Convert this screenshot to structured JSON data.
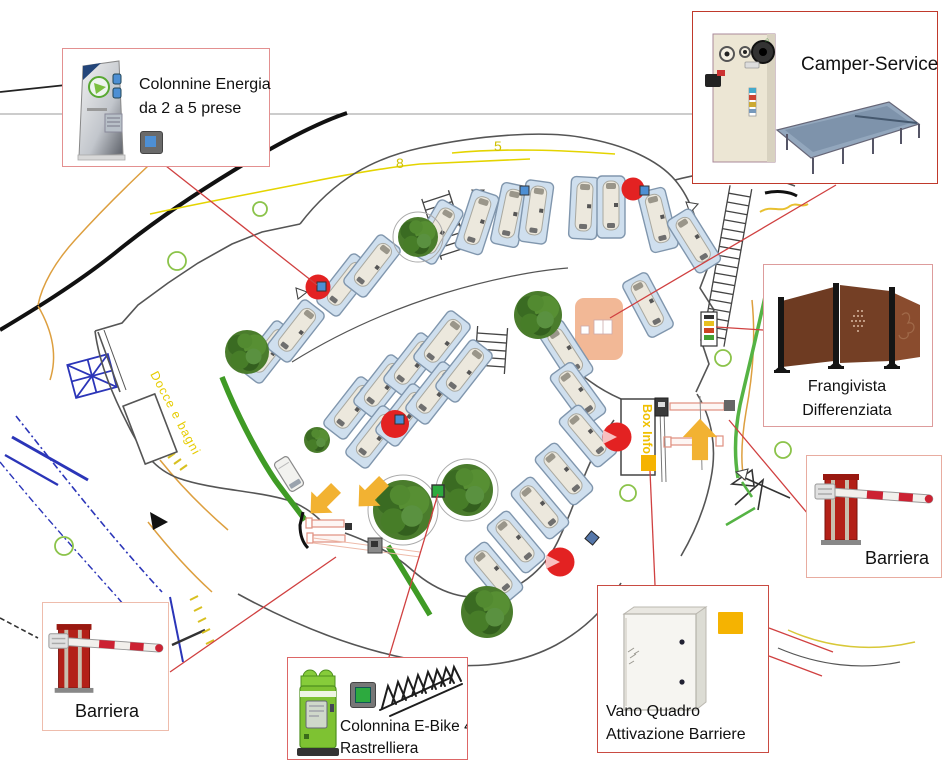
{
  "callouts": {
    "energia": {
      "line1": "Colonnine Energia",
      "line2": "da 2 a 5 prese"
    },
    "camper_service": {
      "label": "Camper-Service"
    },
    "frangivista": {
      "line1": "Frangivista",
      "line2": "Differenziata"
    },
    "barriera_right": {
      "label": "Barriera"
    },
    "barriera_left": {
      "label": "Barriera"
    },
    "ebike": {
      "line1": "Colonnina E-Bike 4p",
      "line2": "Rastrelliera"
    },
    "vano": {
      "line1": "Vano Quadro",
      "line2": "Attivazione Barriere"
    }
  },
  "map_labels": {
    "docce": "Docce e bagni",
    "box_info": "Box Info",
    "route_8": "8",
    "route_5": "5"
  },
  "palette": {
    "energia_marker": "#4d8fd4",
    "ebike_marker": "#2daa3f",
    "vano_marker": "#f5b301",
    "highlight_circle": "#e32222",
    "leader_line": "#d04040",
    "hedge_green": "#3f9b25",
    "road_grey": "#555555",
    "path_yellow": "#e4d400"
  }
}
